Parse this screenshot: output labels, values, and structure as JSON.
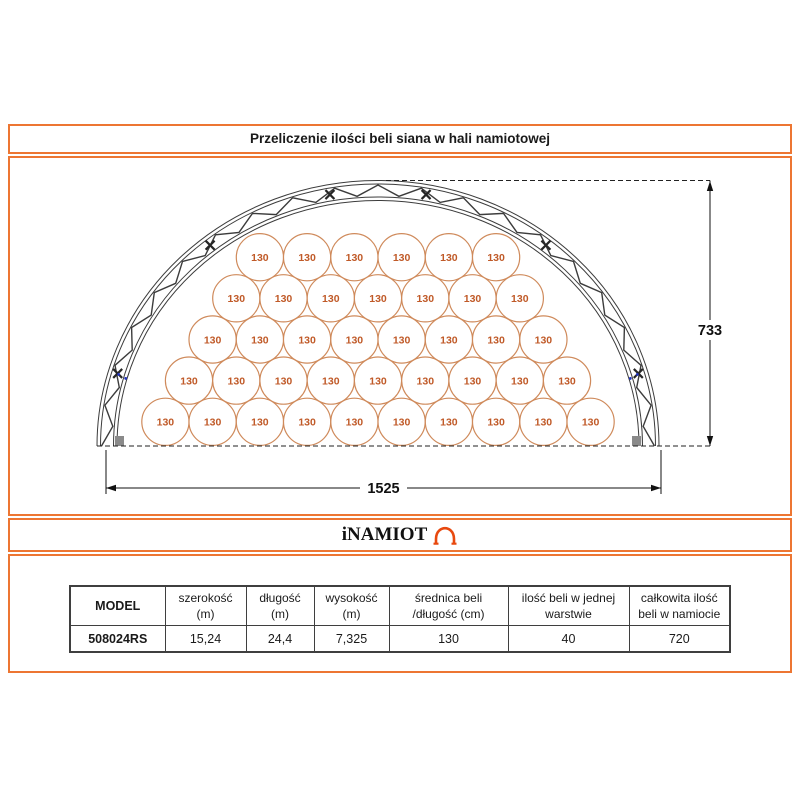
{
  "title": "Przeliczenie ilości beli siana w hali namiotowej",
  "logo": {
    "text": "iNAMIOT",
    "icon": "tent-icon"
  },
  "diagram": {
    "bale_label": "130",
    "rows_top_to_bottom": [
      6,
      7,
      8,
      9,
      10
    ],
    "total_bales_in_layer": 40,
    "height_dim": "733",
    "width_dim": "1525"
  },
  "table": {
    "columns": [
      {
        "line1": "MODEL",
        "line2": ""
      },
      {
        "line1": "szerokość",
        "line2": "(m)"
      },
      {
        "line1": "długość",
        "line2": "(m)"
      },
      {
        "line1": "wysokość",
        "line2": "(m)"
      },
      {
        "line1": "średnica beli",
        "line2": "/długość (cm)"
      },
      {
        "line1": "ilość beli w jednej",
        "line2": "warstwie"
      },
      {
        "line1": "całkowita ilość",
        "line2": "beli w namiocie"
      }
    ],
    "row": [
      "508024RS",
      "15,24",
      "24,4",
      "7,325",
      "130",
      "40",
      "720"
    ]
  },
  "colors": {
    "accent_border": "#ED7632",
    "bale_stroke": "#CF8A5B",
    "bale_text": "#C05A28",
    "truss": "#3c3c3c",
    "logo_icon": "#E8490F",
    "dim": "#111111"
  }
}
